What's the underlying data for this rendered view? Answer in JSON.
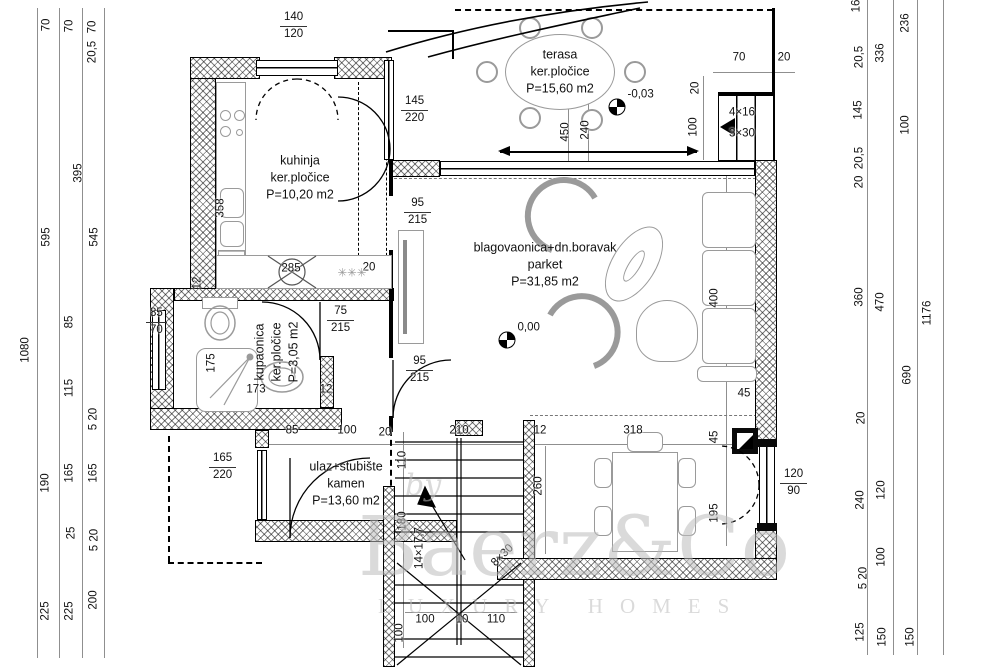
{
  "watermark": {
    "by": "by",
    "name": "Baerz&Co",
    "tagline": "LUXURY HOMES"
  },
  "rooms": [
    {
      "name": "kuhinja",
      "finish": "ker.pločice",
      "area": "P=10,20 m2",
      "x": 300,
      "y": 178
    },
    {
      "name": "terasa",
      "finish": "ker.pločice",
      "area": "P=15,60 m2",
      "x": 560,
      "y": 72
    },
    {
      "name": "blagovaonica+dn.boravak",
      "finish": "parket",
      "area": "P=31,85 m2",
      "x": 545,
      "y": 265
    },
    {
      "name": "kupaonica",
      "finish": "ker.pločice",
      "area": "P=3,05 m2",
      "x": 277,
      "y": 352,
      "rot": -90
    },
    {
      "name": "ulaz+stubište",
      "finish": "kamen",
      "area": "P=13,60 m2",
      "x": 346,
      "y": 484
    }
  ],
  "openings": [
    {
      "w": "140",
      "h": "120",
      "x": 280,
      "y": 10
    },
    {
      "w": "145",
      "h": "220",
      "x": 401,
      "y": 94
    },
    {
      "w": "95",
      "h": "215",
      "x": 404,
      "y": 196
    },
    {
      "w": "95",
      "h": "215",
      "x": 406,
      "y": 354
    },
    {
      "w": "75",
      "h": "215",
      "x": 327,
      "y": 304
    },
    {
      "w": "85",
      "h": "70",
      "x": 146,
      "y": 306
    },
    {
      "w": "165",
      "h": "220",
      "x": 209,
      "y": 451
    },
    {
      "w": "120",
      "h": "90",
      "x": 780,
      "y": 467
    }
  ],
  "levels": [
    {
      "label": "-0,03",
      "x": 617,
      "y": 107
    },
    {
      "label": "0,00",
      "x": 507,
      "y": 340
    }
  ],
  "dims": {
    "v": [
      {
        "t": "70",
        "x": 47,
        "y": 25
      },
      {
        "t": "70",
        "x": 70,
        "y": 26
      },
      {
        "t": "70",
        "x": 93,
        "y": 27
      },
      {
        "t": "20,5",
        "x": 93,
        "y": 52
      },
      {
        "t": "595",
        "x": 47,
        "y": 237
      },
      {
        "t": "545",
        "x": 95,
        "y": 237
      },
      {
        "t": "395",
        "x": 79,
        "y": 173
      },
      {
        "t": "1080",
        "x": 26,
        "y": 350
      },
      {
        "t": "85",
        "x": 70,
        "y": 322
      },
      {
        "t": "115",
        "x": 70,
        "y": 388
      },
      {
        "t": "5 20",
        "x": 94,
        "y": 419
      },
      {
        "t": "190",
        "x": 46,
        "y": 483
      },
      {
        "t": "165",
        "x": 70,
        "y": 473
      },
      {
        "t": "165",
        "x": 94,
        "y": 473
      },
      {
        "t": "25",
        "x": 72,
        "y": 533
      },
      {
        "t": "5 20",
        "x": 95,
        "y": 540
      },
      {
        "t": "225",
        "x": 46,
        "y": 611
      },
      {
        "t": "225",
        "x": 70,
        "y": 611
      },
      {
        "t": "200",
        "x": 94,
        "y": 600
      },
      {
        "t": "16",
        "x": 857,
        "y": 6
      },
      {
        "t": "20,5",
        "x": 860,
        "y": 57
      },
      {
        "t": "336",
        "x": 881,
        "y": 53
      },
      {
        "t": "236",
        "x": 906,
        "y": 23
      },
      {
        "t": "145",
        "x": 859,
        "y": 110
      },
      {
        "t": "100",
        "x": 906,
        "y": 125
      },
      {
        "t": "20,5",
        "x": 860,
        "y": 158
      },
      {
        "t": "20",
        "x": 860,
        "y": 182
      },
      {
        "t": "360",
        "x": 860,
        "y": 297
      },
      {
        "t": "470",
        "x": 881,
        "y": 302
      },
      {
        "t": "1176",
        "x": 928,
        "y": 313
      },
      {
        "t": "690",
        "x": 908,
        "y": 375
      },
      {
        "t": "20",
        "x": 862,
        "y": 418
      },
      {
        "t": "240",
        "x": 861,
        "y": 500
      },
      {
        "t": "120",
        "x": 882,
        "y": 490
      },
      {
        "t": "100",
        "x": 882,
        "y": 557
      },
      {
        "t": "5 20",
        "x": 864,
        "y": 578
      },
      {
        "t": "125",
        "x": 861,
        "y": 632
      },
      {
        "t": "150",
        "x": 883,
        "y": 637
      },
      {
        "t": "150",
        "x": 911,
        "y": 637
      },
      {
        "t": "358",
        "x": 221,
        "y": 208
      },
      {
        "t": "12",
        "x": 198,
        "y": 283
      },
      {
        "t": "450",
        "x": 566,
        "y": 132
      },
      {
        "t": "240",
        "x": 586,
        "y": 130
      },
      {
        "t": "20",
        "x": 696,
        "y": 88
      },
      {
        "t": "100",
        "x": 694,
        "y": 127
      },
      {
        "t": "400",
        "x": 715,
        "y": 298
      },
      {
        "t": "45",
        "x": 715,
        "y": 437
      },
      {
        "t": "195",
        "x": 715,
        "y": 513
      },
      {
        "t": "110",
        "x": 403,
        "y": 460
      },
      {
        "t": "180",
        "x": 403,
        "y": 521
      },
      {
        "t": "260",
        "x": 539,
        "y": 486
      },
      {
        "t": "175",
        "x": 212,
        "y": 363
      },
      {
        "t": "100",
        "x": 400,
        "y": 633
      },
      {
        "t": "8×30",
        "x": 503,
        "y": 556,
        "rot": -45
      },
      {
        "t": "14×17,7",
        "x": 420,
        "y": 548
      }
    ],
    "h": [
      {
        "t": "70",
        "x": 739,
        "y": 58
      },
      {
        "t": "20",
        "x": 784,
        "y": 58
      },
      {
        "t": "285",
        "x": 291,
        "y": 269
      },
      {
        "t": "20",
        "x": 369,
        "y": 268
      },
      {
        "t": "✳✳✳",
        "x": 352,
        "y": 274,
        "c": 1
      },
      {
        "t": "12",
        "x": 326,
        "y": 390
      },
      {
        "t": "173",
        "x": 256,
        "y": 390
      },
      {
        "t": "85",
        "x": 292,
        "y": 431
      },
      {
        "t": "100",
        "x": 347,
        "y": 431
      },
      {
        "t": "20",
        "x": 385,
        "y": 433
      },
      {
        "t": "210",
        "x": 459,
        "y": 431
      },
      {
        "t": "12",
        "x": 540,
        "y": 431
      },
      {
        "t": "318",
        "x": 633,
        "y": 431
      },
      {
        "t": "45",
        "x": 744,
        "y": 394
      },
      {
        "t": "100",
        "x": 425,
        "y": 620
      },
      {
        "t": "10",
        "x": 462,
        "y": 620
      },
      {
        "t": "110",
        "x": 496,
        "y": 620
      },
      {
        "t": "4×16",
        "x": 742,
        "y": 113
      },
      {
        "t": "3×30",
        "x": 742,
        "y": 134
      }
    ]
  }
}
